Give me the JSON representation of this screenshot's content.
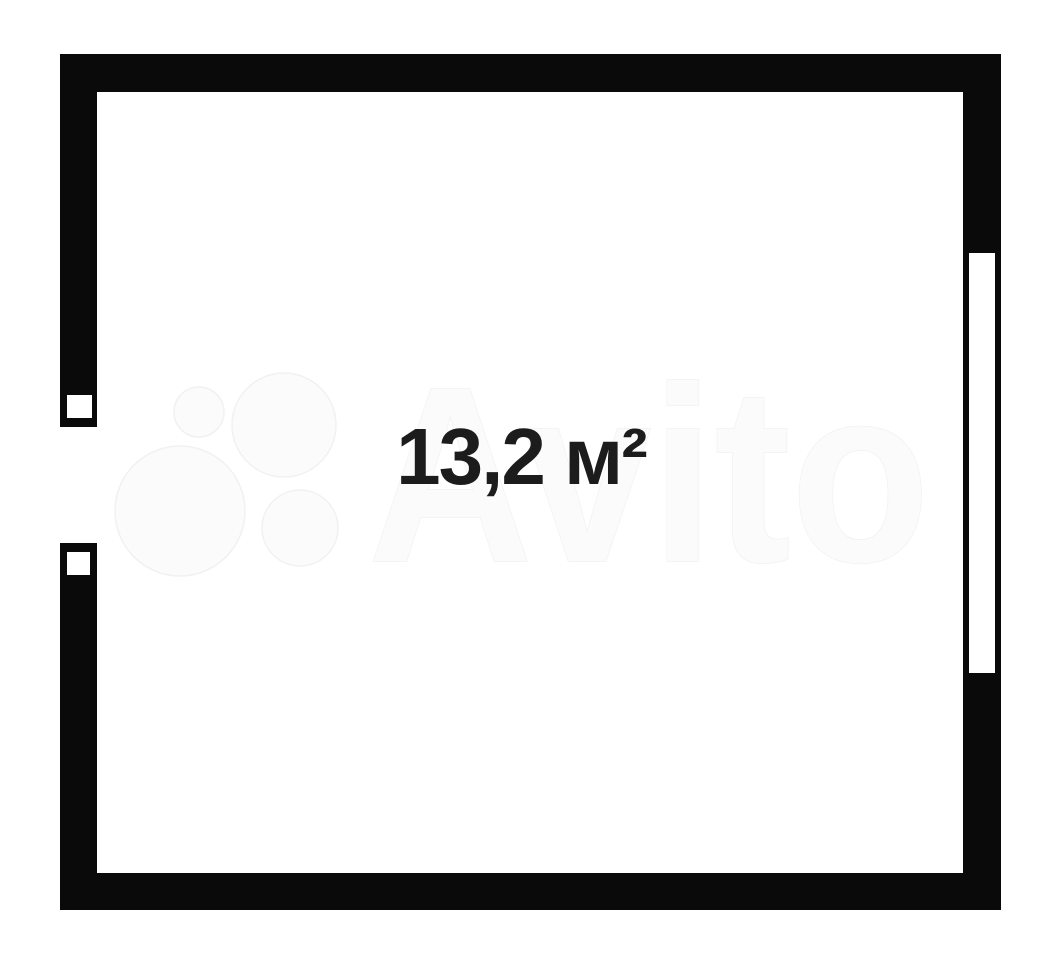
{
  "floorplan": {
    "area_label": "13,2 м²",
    "watermark_text": "Avito",
    "colors": {
      "background": "#ffffff",
      "wall": "#0a0a0a",
      "area_label": "#1c1c1c",
      "watermark_fill": "#fbfbfb",
      "watermark_edge": "#f1f1f1"
    }
  }
}
